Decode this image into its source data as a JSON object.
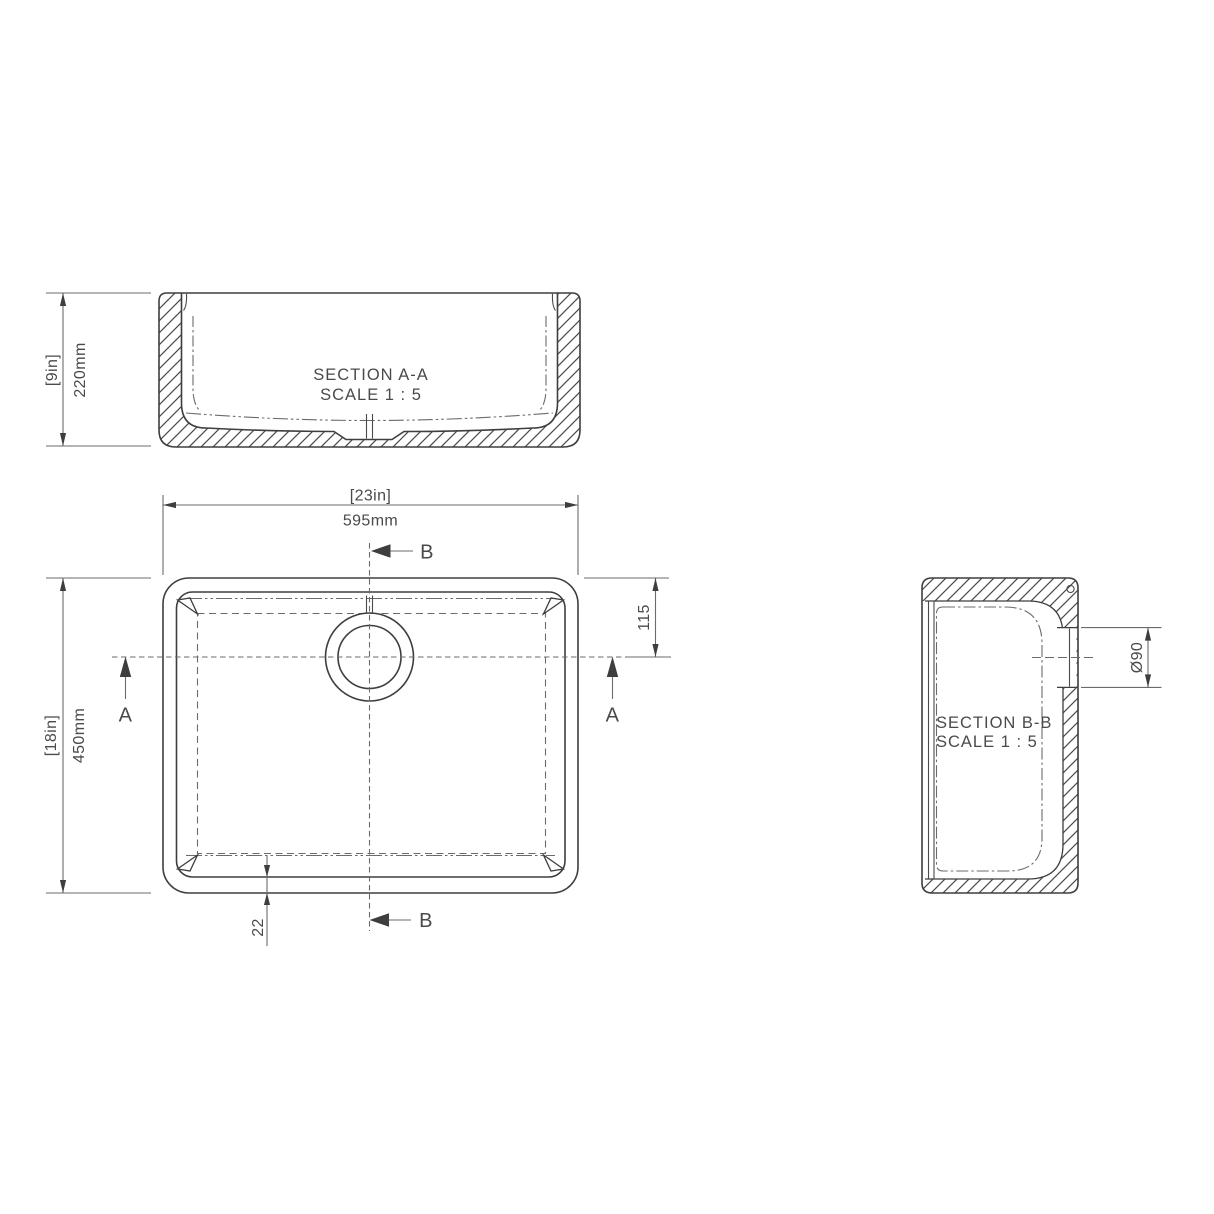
{
  "drawing": {
    "background": "#ffffff",
    "colors": {
      "line": "#3e3e3e",
      "secondary": "#6b6b6b",
      "text": "#4a4a4a"
    },
    "section_aa": {
      "title": "SECTION A-A",
      "scale": "SCALE 1 : 5",
      "dim_height_in": "[9in]",
      "dim_height_mm": "220mm"
    },
    "plan": {
      "dim_width_in": "[23in]",
      "dim_width_mm": "595mm",
      "dim_depth_in": "[18in]",
      "dim_depth_mm": "450mm",
      "dim_drain_offset": "115",
      "dim_wall_thickness": "22",
      "marker_a": "A",
      "marker_b": "B"
    },
    "section_bb": {
      "title": "SECTION B-B",
      "scale": "SCALE 1 : 5",
      "dim_drain_diameter": "Ø90"
    }
  }
}
